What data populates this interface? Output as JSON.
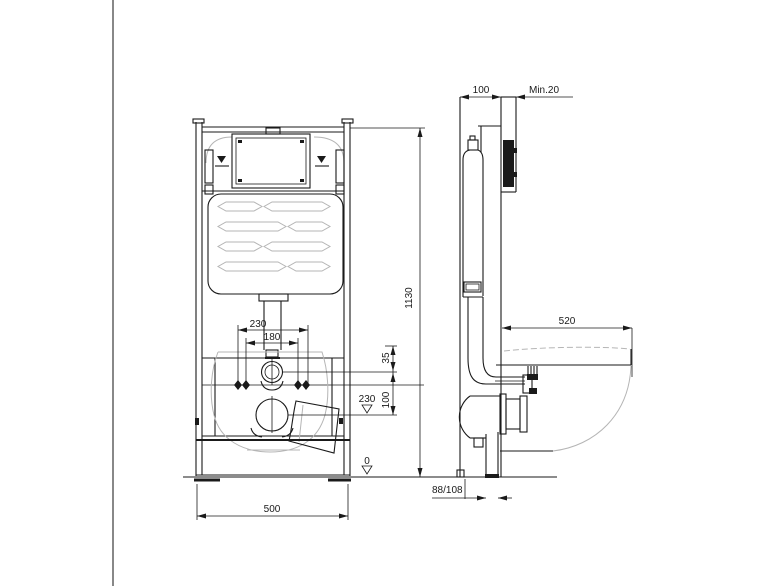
{
  "drawing": {
    "type": "technical-installation-diagram",
    "subject": "wall-hung-wc-concealed-cistern-frame",
    "views": {
      "front": {
        "label": "front view",
        "dimensions": {
          "bolt_spacing_outer": "230",
          "bolt_spacing_inner": "180",
          "inlet_offset": "35",
          "inlet_to_outlet": "100",
          "outlet_height_level": "230",
          "floor_level": "0",
          "frame_height": "1130",
          "frame_width": "500"
        }
      },
      "side": {
        "label": "side view",
        "dimensions": {
          "frame_depth": "100",
          "min_clearance": "Min.20",
          "bowl_projection": "520",
          "outlet_pipe_diameter": "88/108"
        }
      }
    },
    "colors": {
      "line": "#1a1a1a",
      "light_line": "#b5b5b5",
      "background": "#ffffff"
    }
  }
}
